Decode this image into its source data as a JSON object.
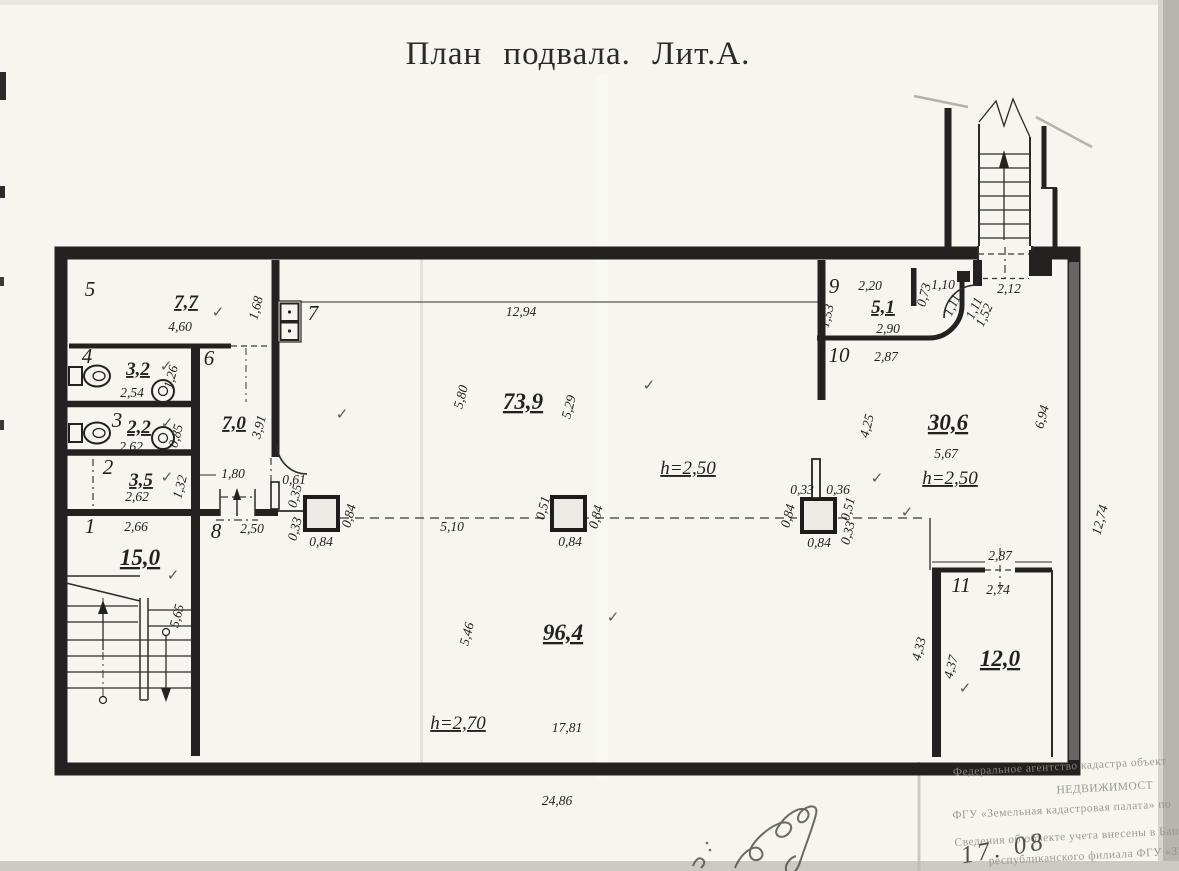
{
  "title": "План подвала. Лит.А.",
  "colors": {
    "paper": "#f6f5f0",
    "ink": "#232220",
    "stamp_gray": "#908f8a"
  },
  "labels": [
    {
      "t": "5",
      "x": 90,
      "y": 296,
      "c": "room"
    },
    {
      "t": "7,7",
      "x": 186,
      "y": 308,
      "c": "area"
    },
    {
      "t": "✓",
      "x": 218,
      "y": 317,
      "c": "check"
    },
    {
      "t": "4,60",
      "x": 180,
      "y": 331,
      "c": "dim"
    },
    {
      "t": "1,68",
      "x": 260,
      "y": 309,
      "r": -75,
      "c": "dim"
    },
    {
      "t": "7",
      "x": 313,
      "y": 320,
      "c": "room"
    },
    {
      "t": "4",
      "x": 87,
      "y": 363,
      "c": "room"
    },
    {
      "t": "3,2",
      "x": 138,
      "y": 375,
      "c": "area"
    },
    {
      "t": "✓",
      "x": 166,
      "y": 371,
      "c": "check"
    },
    {
      "t": "1,26",
      "x": 175,
      "y": 378,
      "r": -75,
      "c": "dim"
    },
    {
      "t": "6",
      "x": 209,
      "y": 365,
      "c": "room"
    },
    {
      "t": "2,54",
      "x": 132,
      "y": 397,
      "c": "dim"
    },
    {
      "t": "3",
      "x": 117,
      "y": 427,
      "c": "room"
    },
    {
      "t": "2,2",
      "x": 139,
      "y": 433,
      "c": "area"
    },
    {
      "t": "✓",
      "x": 167,
      "y": 428,
      "c": "check"
    },
    {
      "t": "2,62",
      "x": 131,
      "y": 451,
      "c": "dim"
    },
    {
      "t": "0,85",
      "x": 180,
      "y": 437,
      "r": -75,
      "c": "dim"
    },
    {
      "t": "7,0",
      "x": 234,
      "y": 429,
      "c": "area"
    },
    {
      "t": "3,91",
      "x": 263,
      "y": 428,
      "r": -75,
      "c": "dim"
    },
    {
      "t": "2",
      "x": 108,
      "y": 474,
      "c": "room"
    },
    {
      "t": "3,5",
      "x": 141,
      "y": 486,
      "c": "area"
    },
    {
      "t": "✓",
      "x": 167,
      "y": 482,
      "c": "check"
    },
    {
      "t": "2,62",
      "x": 137,
      "y": 501,
      "c": "dim"
    },
    {
      "t": "1,32",
      "x": 184,
      "y": 488,
      "r": -75,
      "c": "dim"
    },
    {
      "t": "1,80",
      "x": 233,
      "y": 478,
      "c": "dim"
    },
    {
      "t": "1",
      "x": 90,
      "y": 533,
      "c": "room"
    },
    {
      "t": "2,66",
      "x": 136,
      "y": 531,
      "c": "dim"
    },
    {
      "t": "8",
      "x": 216,
      "y": 538,
      "c": "room"
    },
    {
      "t": "2,50",
      "x": 252,
      "y": 533,
      "c": "dim"
    },
    {
      "t": "15,0",
      "x": 140,
      "y": 565,
      "c": "area-lg"
    },
    {
      "t": "✓",
      "x": 173,
      "y": 580,
      "c": "check"
    },
    {
      "t": "5,65",
      "x": 181,
      "y": 617,
      "r": -75,
      "c": "dim"
    },
    {
      "t": "0,61",
      "x": 294,
      "y": 484,
      "c": "dim"
    },
    {
      "t": "0,35",
      "x": 299,
      "y": 497,
      "r": -75,
      "c": "dim"
    },
    {
      "t": "0,33",
      "x": 299,
      "y": 530,
      "r": -75,
      "c": "dim"
    },
    {
      "t": "0,84",
      "x": 353,
      "y": 517,
      "r": -75,
      "c": "dim"
    },
    {
      "t": "0,84",
      "x": 321,
      "y": 546,
      "c": "dim"
    },
    {
      "t": "✓",
      "x": 342,
      "y": 419,
      "c": "check"
    },
    {
      "t": "5,10",
      "x": 452,
      "y": 531,
      "c": "dim"
    },
    {
      "t": "0,51",
      "x": 547,
      "y": 509,
      "r": -75,
      "c": "dim"
    },
    {
      "t": "0,84",
      "x": 600,
      "y": 518,
      "r": -75,
      "c": "dim"
    },
    {
      "t": "0,84",
      "x": 570,
      "y": 546,
      "c": "dim"
    },
    {
      "t": "0,33",
      "x": 802,
      "y": 494,
      "c": "dim"
    },
    {
      "t": "0,36",
      "x": 838,
      "y": 494,
      "c": "dim"
    },
    {
      "t": "0,51",
      "x": 852,
      "y": 510,
      "r": -75,
      "c": "dim"
    },
    {
      "t": "0,33",
      "x": 852,
      "y": 534,
      "r": -75,
      "c": "dim"
    },
    {
      "t": "0,84",
      "x": 792,
      "y": 517,
      "r": -75,
      "c": "dim"
    },
    {
      "t": "0,84",
      "x": 819,
      "y": 547,
      "c": "dim"
    },
    {
      "t": "✓",
      "x": 907,
      "y": 517,
      "c": "check"
    },
    {
      "t": "12,94",
      "x": 521,
      "y": 316,
      "c": "dim"
    },
    {
      "t": "5,80",
      "x": 465,
      "y": 398,
      "r": -75,
      "c": "dim"
    },
    {
      "t": "73,9",
      "x": 523,
      "y": 409,
      "c": "area-lg"
    },
    {
      "t": "5,29",
      "x": 573,
      "y": 408,
      "r": -75,
      "c": "dim"
    },
    {
      "t": "✓",
      "x": 649,
      "y": 390,
      "c": "check"
    },
    {
      "t": "h=2,50",
      "x": 688,
      "y": 474,
      "c": "height"
    },
    {
      "t": "5,46",
      "x": 471,
      "y": 635,
      "r": -75,
      "c": "dim"
    },
    {
      "t": "96,4",
      "x": 563,
      "y": 640,
      "c": "area-lg"
    },
    {
      "t": "✓",
      "x": 613,
      "y": 622,
      "c": "check"
    },
    {
      "t": "h=2,70",
      "x": 458,
      "y": 729,
      "c": "height"
    },
    {
      "t": "17,81",
      "x": 567,
      "y": 732,
      "c": "dim"
    },
    {
      "t": "24,86",
      "x": 557,
      "y": 805,
      "c": "dim"
    },
    {
      "t": "9",
      "x": 834,
      "y": 293,
      "c": "room"
    },
    {
      "t": "2,20",
      "x": 870,
      "y": 290,
      "c": "dim"
    },
    {
      "t": "5,1",
      "x": 883,
      "y": 313,
      "c": "area"
    },
    {
      "t": "1,53",
      "x": 831,
      "y": 317,
      "r": -75,
      "c": "dim"
    },
    {
      "t": "2,90",
      "x": 888,
      "y": 333,
      "c": "dim"
    },
    {
      "t": "0,73",
      "x": 928,
      "y": 296,
      "r": -75,
      "c": "dim"
    },
    {
      "t": "1,10",
      "x": 943,
      "y": 289,
      "c": "dim"
    },
    {
      "t": "1,11",
      "x": 956,
      "y": 307,
      "r": -65,
      "c": "dim"
    },
    {
      "t": "1,11",
      "x": 978,
      "y": 310,
      "r": -65,
      "c": "dim"
    },
    {
      "t": "1,52",
      "x": 988,
      "y": 317,
      "r": -65,
      "c": "dim"
    },
    {
      "t": "2,12",
      "x": 1009,
      "y": 293,
      "c": "dim"
    },
    {
      "t": "10",
      "x": 839,
      "y": 362,
      "c": "room"
    },
    {
      "t": "2,87",
      "x": 886,
      "y": 361,
      "c": "dim"
    },
    {
      "t": "4,25",
      "x": 871,
      "y": 427,
      "r": -75,
      "c": "dim"
    },
    {
      "t": "30,6",
      "x": 948,
      "y": 430,
      "c": "area-lg"
    },
    {
      "t": "5,67",
      "x": 946,
      "y": 458,
      "c": "dim"
    },
    {
      "t": "h=2,50",
      "x": 950,
      "y": 484,
      "c": "height"
    },
    {
      "t": "✓",
      "x": 877,
      "y": 483,
      "c": "check"
    },
    {
      "t": "6,94",
      "x": 1046,
      "y": 418,
      "r": -75,
      "c": "dim"
    },
    {
      "t": "12,74",
      "x": 1104,
      "y": 521,
      "r": -75,
      "c": "dim"
    },
    {
      "t": "2,87",
      "x": 1000,
      "y": 560,
      "c": "dim"
    },
    {
      "t": "11",
      "x": 961,
      "y": 592,
      "c": "room"
    },
    {
      "t": "2,74",
      "x": 998,
      "y": 594,
      "c": "dim"
    },
    {
      "t": "12,0",
      "x": 1000,
      "y": 666,
      "c": "area-lg"
    },
    {
      "t": "4,37",
      "x": 955,
      "y": 668,
      "r": -75,
      "c": "dim"
    },
    {
      "t": "4,33",
      "x": 923,
      "y": 650,
      "r": -75,
      "c": "dim"
    },
    {
      "t": "✓",
      "x": 965,
      "y": 693,
      "c": "check"
    },
    {
      "t": "Федеральное агентство кадастра объект",
      "x": 1060,
      "y": 770,
      "r": -3,
      "c": "stamp"
    },
    {
      "t": "НЕДВИЖИМОСТ",
      "x": 1105,
      "y": 791,
      "r": -3,
      "c": "stamp"
    },
    {
      "t": "ФГУ «Земельная кадастровая палата» по",
      "x": 1062,
      "y": 813,
      "r": -3,
      "c": "stamp"
    },
    {
      "t": "Сведения об объекте учета внесены в Баш",
      "x": 1068,
      "y": 840,
      "r": -3,
      "c": "stamp"
    },
    {
      "t": "республиканского филиала ФГУ «ЗКП»",
      "x": 1095,
      "y": 859,
      "r": -3,
      "c": "stamp"
    },
    {
      "t": "17. 08",
      "x": 1005,
      "y": 856,
      "r": -10,
      "c": "handdate"
    }
  ]
}
